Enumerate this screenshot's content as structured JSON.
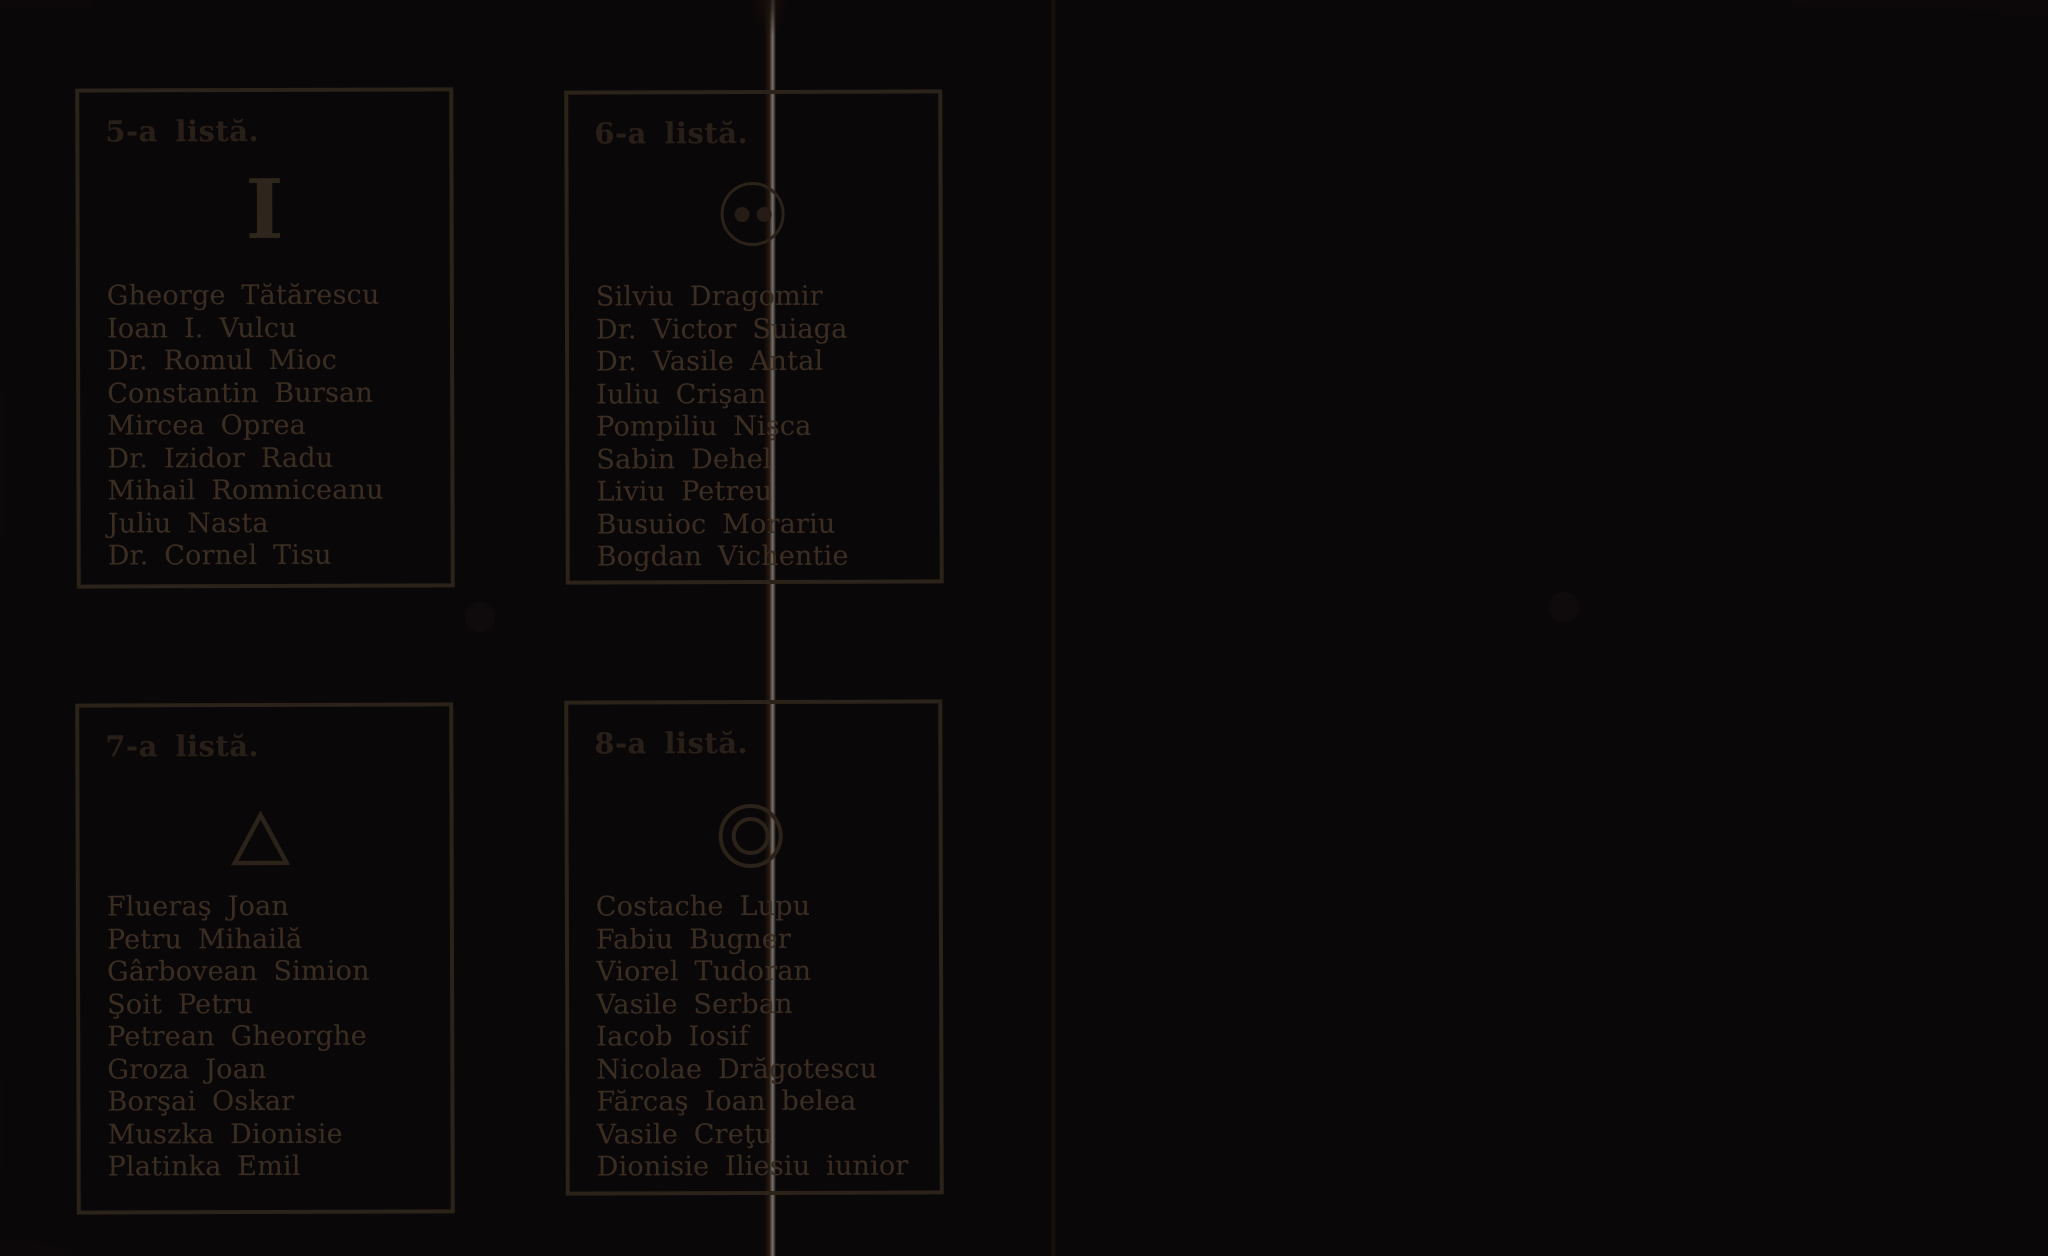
{
  "document_type": "ballot-paper",
  "colors": {
    "paper": "#f3dcb2",
    "ink": "#3a2d22",
    "border": "#2b2219",
    "hole": "#0f0b0d"
  },
  "ballots": [
    {
      "title": "5-a listă.",
      "symbol": "vertical-bar",
      "symbol_glyph": "I",
      "names": [
        "Gheorge Tătărescu",
        "Ioan I. Vulcu",
        "Dr. Romul Mioc",
        "Constantin Bursan",
        "Mircea Oprea",
        "Dr. Izidor Radu",
        "Mihail Romniceanu",
        "Juliu Nasta",
        "Dr. Cornel Tisu"
      ]
    },
    {
      "title": "6-a listă.",
      "symbol": "circle-with-two-dots",
      "names": [
        "Silviu Dragomir",
        "Dr. Victor Suiaga",
        "Dr. Vasile Antal",
        "Iuliu Crişan",
        "Pompiliu Nişca",
        "Sabin Dehel",
        "Liviu Petreu",
        "Busuioc Morariu",
        "Bogdan Vichentie"
      ]
    },
    {
      "title": "7-a listă.",
      "symbol": "triangle-outline",
      "names": [
        "Flueraş Joan",
        "Petru Mihailă",
        "Gârbovean Simion",
        "Şoit Petru",
        "Petrean Gheorghe",
        "Groza Joan",
        "Borşai Oskar",
        "Muszka Dionisie",
        "Platinka Emil"
      ]
    },
    {
      "title": "8-a listă.",
      "symbol": "double-circle",
      "names": [
        "Costache Lupu",
        "Fabiu Bugner",
        "Viorel Tudoran",
        "Vasile Serban",
        "Iacob Iosif",
        "Nicolae Drăgotescu",
        "Fărcaş Ioan belea",
        "Vasile Creţu",
        "Dionisie Iliesiu iunior"
      ]
    }
  ]
}
